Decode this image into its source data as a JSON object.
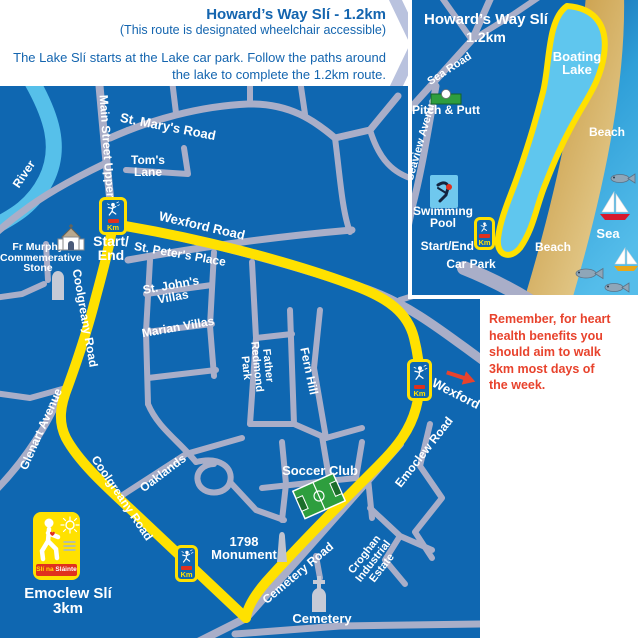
{
  "header": {
    "title": "Howard’s Way Slí - 1.2km",
    "subtitle": "(This route is designated wheelchair accessible)",
    "description": "The Lake Slí starts at the Lake car park. Follow the paths around the lake to complete the 1.2km route."
  },
  "reminder": "Remember, for heart health benefits you should aim to walk 3km most days of the week.",
  "inset": {
    "title": "Howard’s Way Slí",
    "distance": "1.2km",
    "boating_lake": "Boating Lake",
    "sea_road": "Sea Road",
    "pitch_putt": "Pitch & Putt",
    "seaview_avenue": "Seaview Avenue",
    "swimming_pool": "Swimming Pool",
    "start_end": "Start/End",
    "car_park": "Car Park",
    "beach_top": "Beach",
    "beach_bottom": "Beach",
    "sea": "Sea",
    "km": "Km"
  },
  "map": {
    "river": "River",
    "main_street_upper": "Main Street Upper",
    "st_marys_road": "St. Mary's Road",
    "toms_lane": "Tom's Lane",
    "wexford_road": "Wexford Road",
    "st_peters_place": "St. Peter's Place",
    "start_end_1": "Start/",
    "start_end_2": "End",
    "fr_murphy": [
      "Fr Murphy",
      "Commemerative",
      "Stone"
    ],
    "coolgreany_road_upper": "Coolgreany Road",
    "st_johns_villas": "St. John's Villas",
    "marian_villas": "Marian Villas",
    "father_redmond_park": [
      "Father",
      "Redmond",
      "Park"
    ],
    "fern_hill": "Fern Hill",
    "wexford": "Wexford",
    "glenart_avenue": "Glenart Avenue",
    "coolgreany_road_lower": "Coolgreany Road",
    "oaklands": "Oaklands",
    "soccer_club": "Soccer Club",
    "emoclew_road": "Emoclew Road",
    "monument_1": "1798",
    "monument_2": "Monument",
    "cemetery_road": "Cemetery Road",
    "croghan": [
      "Croghan",
      "Industrial",
      "Estate"
    ],
    "cemetery": "Cemetery",
    "km": "Km"
  },
  "legend": {
    "logo_text_a": "Slí na",
    "logo_text_b": "Sláinte",
    "route_name": "Emoclew Slí",
    "route_distance": "3km"
  },
  "colors": {
    "map_blue": "#0f67b1",
    "water_blue": "#5bc2ea",
    "road_gray": "#a9aec8",
    "route_yellow": "#ffe100",
    "text_blue": "#1465af",
    "alert_red": "#e8432d",
    "sand": "#c89434",
    "sea_blue": "#2f9fd8"
  }
}
